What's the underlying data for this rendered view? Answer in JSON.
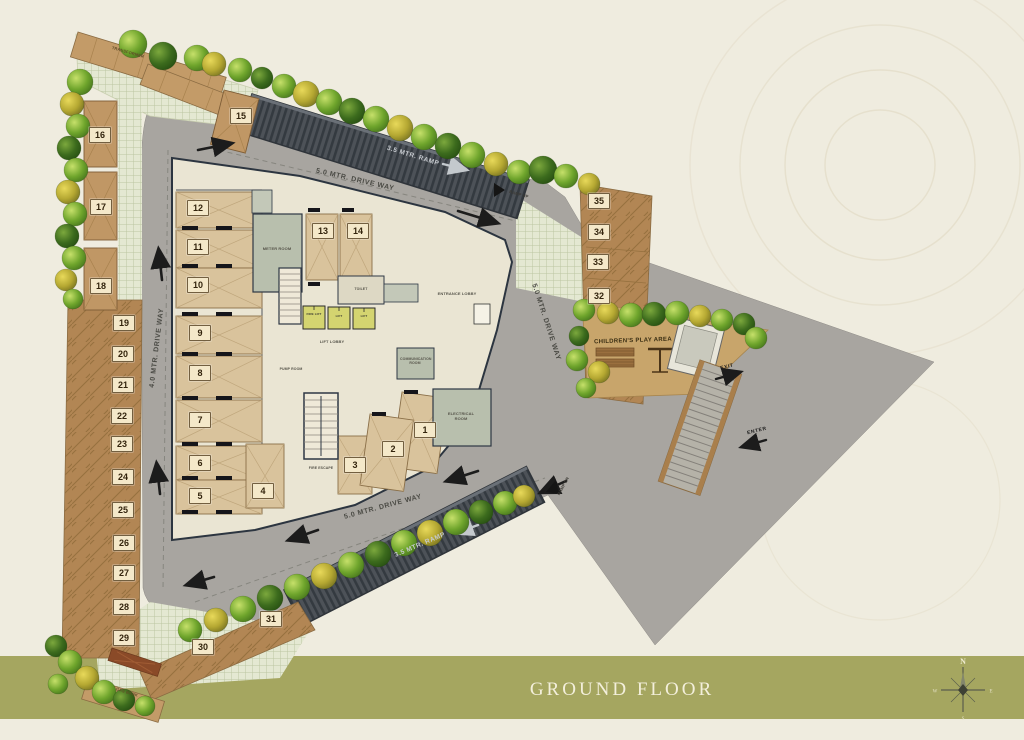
{
  "title_bar": {
    "label": "GROUND FLOOR"
  },
  "compass": {
    "north": "N",
    "east": "E",
    "south": "S",
    "west": "W"
  },
  "road_labels": {
    "top_driveway": "5.0 MTR. DRIVE WAY",
    "left_driveway": "4.0 MTR. DRIVE WAY",
    "right_driveway": "5.0 MTR. DRIVE WAY",
    "bottom_driveway": "5.0 MTR. DRIVE WAY",
    "top_ramp": "3.5 MTR. RAMP",
    "bottom_ramp": "3.5 MTR. RAMP",
    "ramp_up": "RAMP UP",
    "ramp_dn": "RAMP DN"
  },
  "site_labels": {
    "transformer": "TRANSFORMER",
    "gas_bank": "GAS BANK",
    "childrens_play_area": "CHILDREN'S PLAY AREA",
    "exit": "EXIT",
    "enter": "ENTER"
  },
  "building_labels": {
    "entrance_lobby": "ENTRANCE LOBBY",
    "lift_lobby": "LIFT LOBBY",
    "meter_room": "METER ROOM",
    "electrical_room": "ELECTRICAL ROOM",
    "communication_room": "COMMUNICATION ROOM",
    "pump_room": "PUMP ROOM",
    "fire_escape": "FIRE ESCAPE",
    "toilet": "TOILET",
    "fire_lift": "FIRE LIFT",
    "lift": "LIFT"
  },
  "parking": {
    "spots": [
      "1",
      "2",
      "3",
      "4",
      "5",
      "6",
      "7",
      "8",
      "9",
      "10",
      "11",
      "12",
      "13",
      "14",
      "15",
      "16",
      "17",
      "18",
      "19",
      "20",
      "21",
      "22",
      "23",
      "24",
      "25",
      "26",
      "27",
      "28",
      "29",
      "30",
      "31",
      "32",
      "33",
      "34",
      "35"
    ]
  },
  "colors": {
    "footer_bar": "#a5a660",
    "road": "#a8a5a0",
    "ramp": "#4d5258",
    "building": "#eae5d3",
    "stall": "#d9c39c",
    "parking_strip": "#b28654",
    "play_area": "#c8a56b",
    "lift_box": "#d4d470",
    "tree_green": "#6fa52c",
    "chip_bg": "#f4e8c9"
  }
}
